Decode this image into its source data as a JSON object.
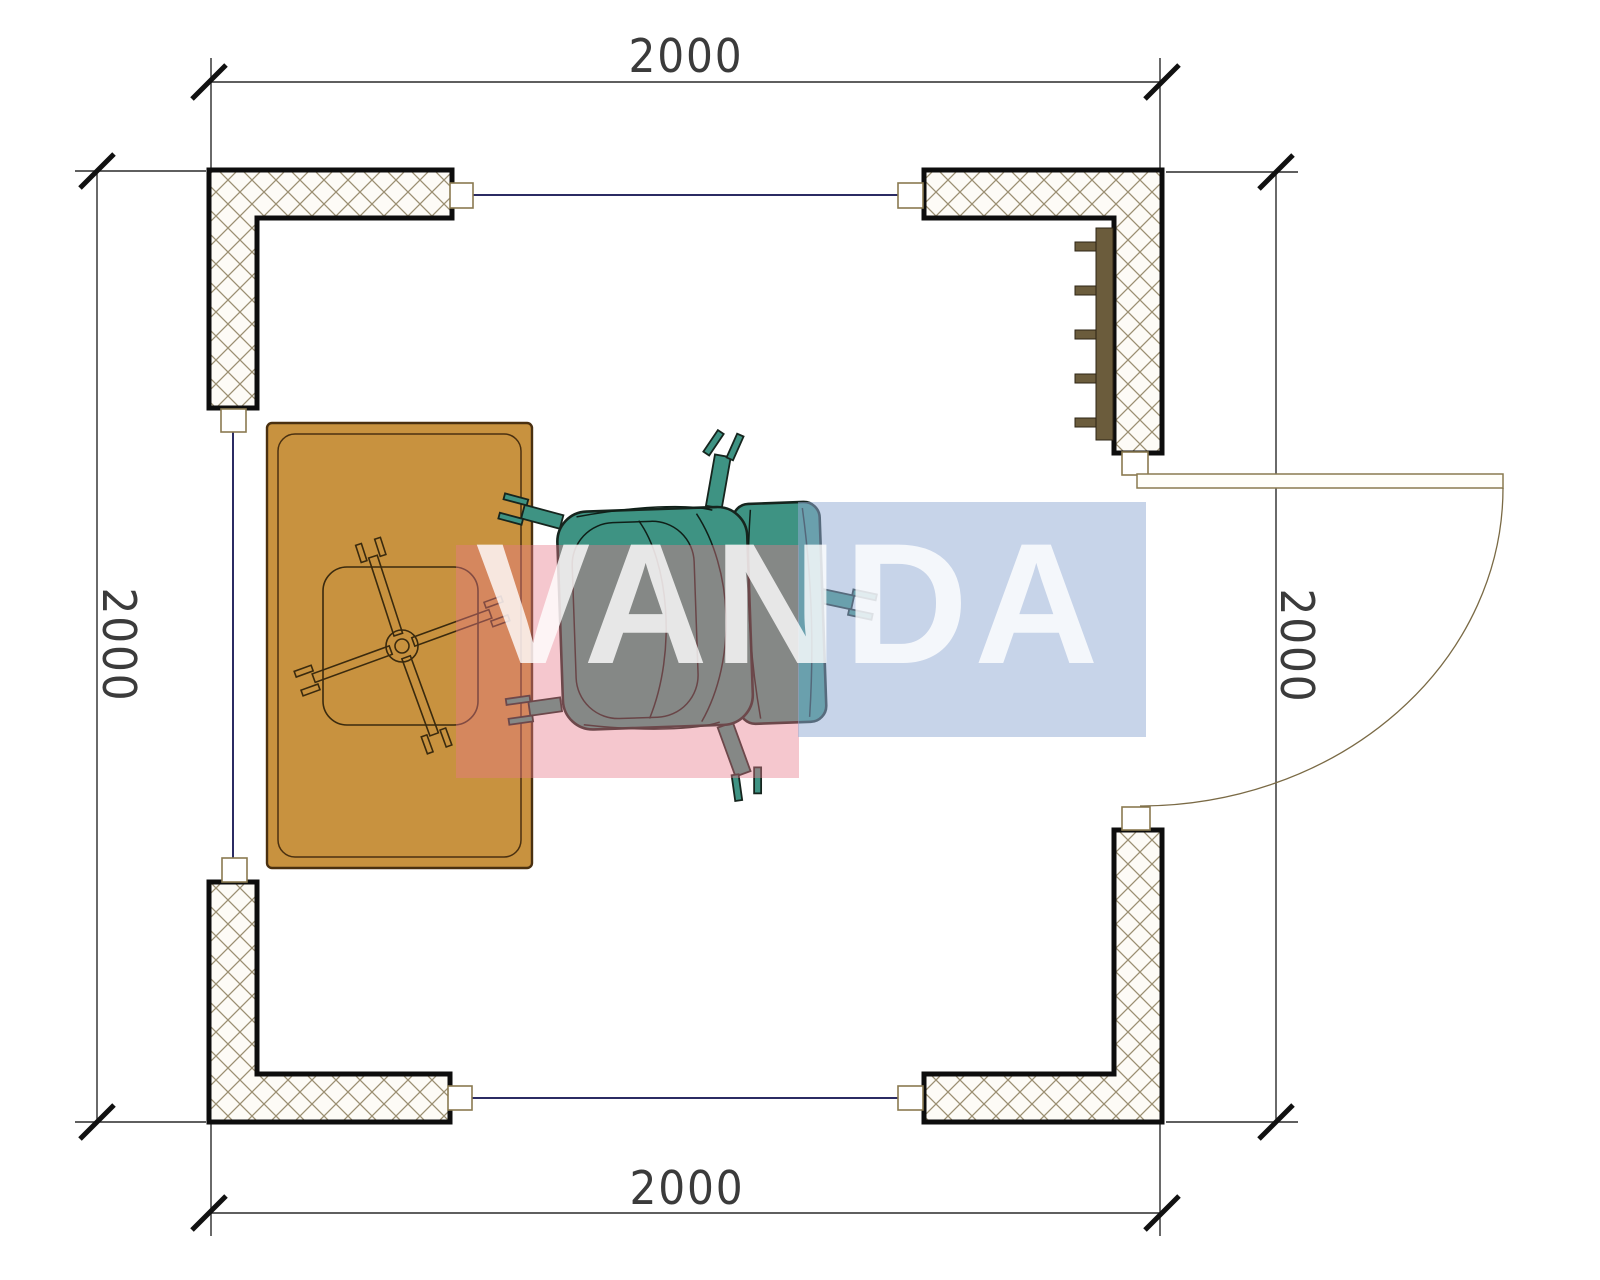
{
  "drawing": {
    "type": "floor-plan-top-view",
    "room": {
      "width_label": "2000",
      "height_label": "2000"
    },
    "dimension_labels": {
      "top": "2000",
      "bottom": "2000",
      "left": "2000",
      "right": "2000"
    },
    "watermark": {
      "text": "VANDA",
      "pink_color": "#E77A8A",
      "blue_color": "#94ACD4",
      "text_color": "#FFFFFF"
    },
    "colors": {
      "wall_outline": "#0d0d0d",
      "hatch_line": "#9b8f72",
      "desk_fill": "#c8923f",
      "desk_outline": "#4a3010",
      "chair_fill": "#3e9383",
      "chair_outline": "#16251e",
      "radiator_fill": "#6b5c3c",
      "window_line": "#2b2b63",
      "door_line": "#8a7a50",
      "dimension_line": "#2a2a2a"
    }
  }
}
